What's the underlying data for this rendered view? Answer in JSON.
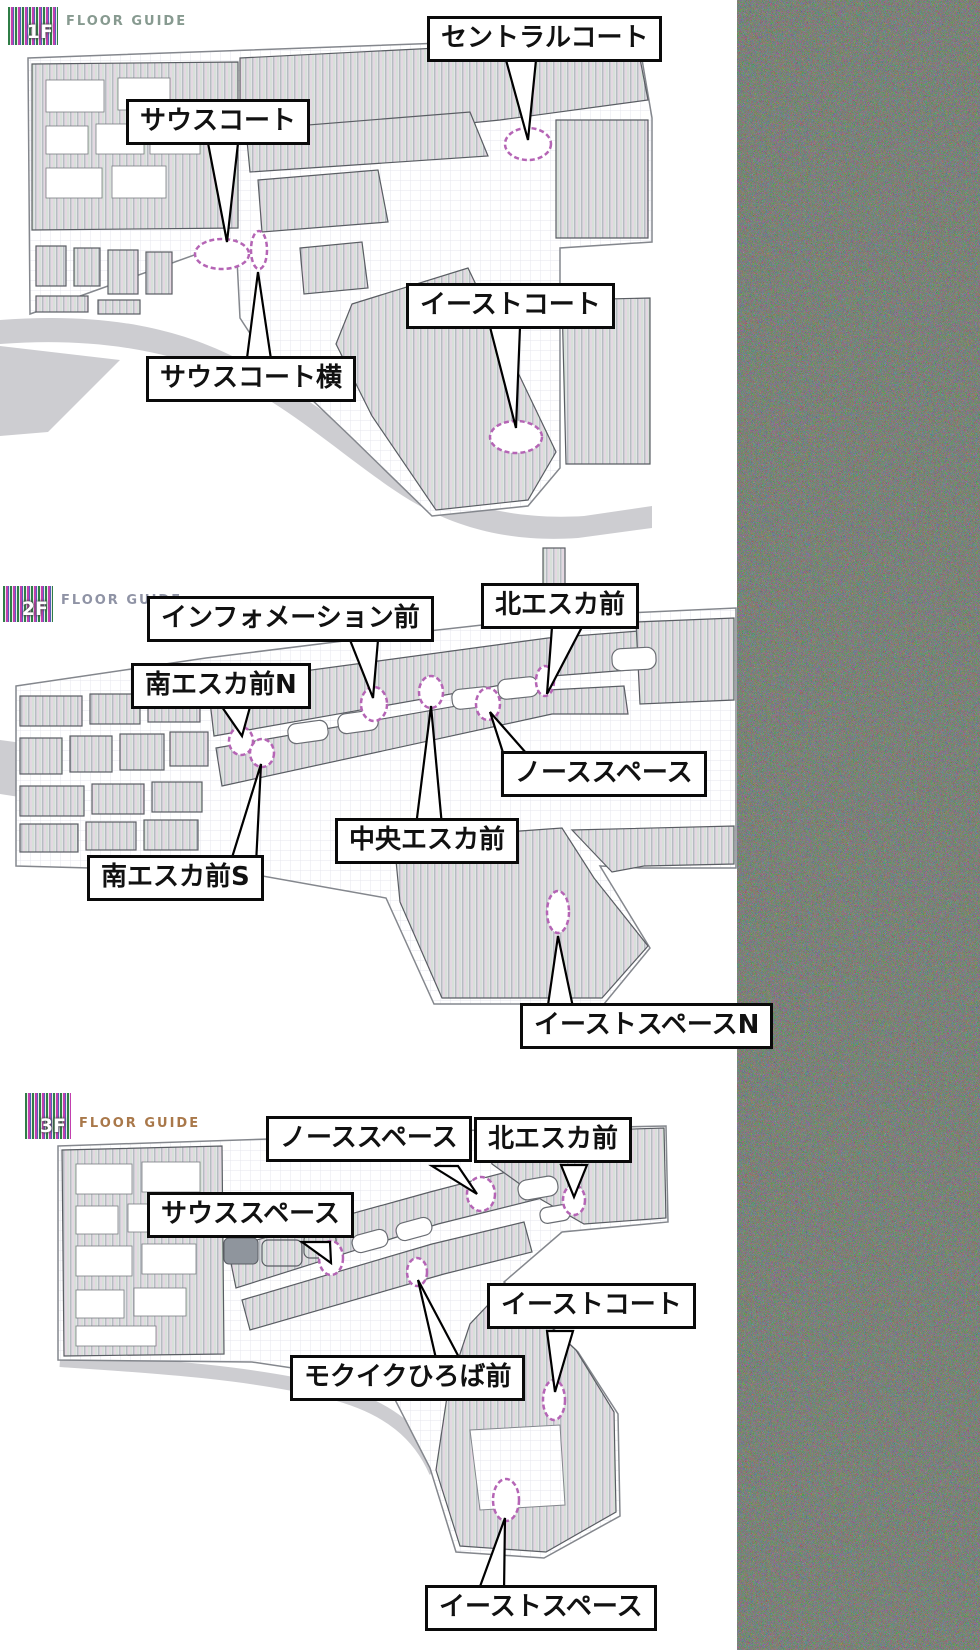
{
  "colors": {
    "callout_border": "#0a0a0a",
    "callout_bg": "#ffffff",
    "marker_ring": "#b565b5",
    "map_block_base": "#e3e3e7",
    "road": "#cdcdd1",
    "floor_guide_text_1f": "#879a90",
    "floor_guide_text_2f": "#8f93a5",
    "floor_guide_text_3f": "#a9784a"
  },
  "floors": [
    {
      "id": "1f",
      "badge": "1F",
      "guide_label": "FLOOR GUIDE",
      "labels": [
        {
          "text": "セントラルコート"
        },
        {
          "text": "サウスコート"
        },
        {
          "text": "イーストコート"
        },
        {
          "text": "サウスコート横"
        }
      ]
    },
    {
      "id": "2f",
      "badge": "2F",
      "guide_label": "FLOOR GUIDE",
      "labels": [
        {
          "text": "インフォメーション前"
        },
        {
          "text": "北エスカ前"
        },
        {
          "text": "南エスカ前N"
        },
        {
          "text": "ノーススペース"
        },
        {
          "text": "中央エスカ前"
        },
        {
          "text": "南エスカ前S"
        },
        {
          "text": "イーストスペースN"
        }
      ]
    },
    {
      "id": "3f",
      "badge": "3F",
      "guide_label": "FLOOR GUIDE",
      "labels": [
        {
          "text": "ノーススペース"
        },
        {
          "text": "北エスカ前"
        },
        {
          "text": "サウススペース"
        },
        {
          "text": "イーストコート"
        },
        {
          "text": "モクイクひろば前"
        },
        {
          "text": "イーストスペース"
        }
      ]
    }
  ]
}
